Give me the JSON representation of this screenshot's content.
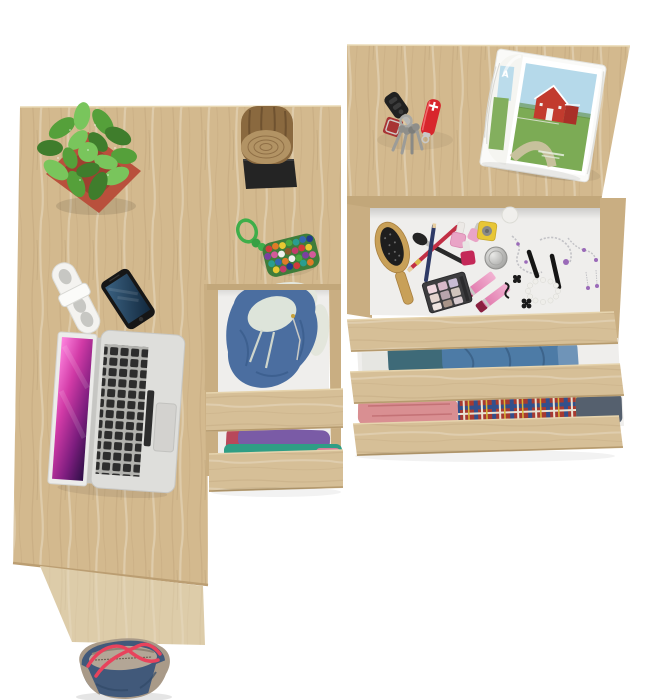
{
  "scene": {
    "description": "Top-down product photo of a light sonoma-oak corner desk unit and matching chest of drawers with open drawers, styled with clothes, cosmetics and accessories on a white background",
    "background_color": "#ffffff"
  },
  "palette": {
    "wood_top": "#d3b98e",
    "wood_front": "#d6bf97",
    "wood_rail": "#c9ae82",
    "wood_edge": "#bb9e72",
    "wood_side_panel": "#ddcca9",
    "drawer_interior": "#efeeec"
  },
  "desk": {
    "label": "corner desk",
    "items": [
      "potted succulent",
      "cable organizer",
      "smartphone",
      "laptop"
    ]
  },
  "cabinet": {
    "label": "desk drawer cabinet",
    "top_items": [
      "log stool on black base",
      "pompom keychain"
    ],
    "drawers": [
      {
        "state": "open",
        "contents": "blue zip hoodie with cream lining"
      },
      {
        "state": "open",
        "contents": "folded purple, teal and red shirts"
      }
    ]
  },
  "dresser": {
    "label": "chest of drawers",
    "top_items": [
      "car key",
      "red pocket knife",
      "keyring with keys",
      "open magazine with red barn photo"
    ],
    "drawers": [
      {
        "state": "open",
        "contents": "cosmetics, makeup and jewelry"
      },
      {
        "state": "open",
        "contents": "folded blue jeans"
      },
      {
        "state": "open",
        "contents": "pink shirts, plaid shirt and dark jeans"
      }
    ]
  },
  "items": {
    "plant": {
      "label": "potted succulent plant",
      "pot_color": "#b9503c",
      "pot_inner": "#9e4030",
      "foliage_dark": "#3f7d2c",
      "foliage_mid": "#55a03a",
      "foliage_light": "#79c55c"
    },
    "cable_organizer": {
      "label": "white cable organizer",
      "body_color": "#f4f3f0",
      "slot_color": "#c7c7c3"
    },
    "smartphone": {
      "label": "smartphone",
      "body_color": "#161616",
      "screen_top": "#3b6282",
      "screen_bottom": "#12283d"
    },
    "laptop": {
      "label": "open laptop",
      "body_color": "#dededb",
      "keyboard_bed": "#b2b2ae",
      "key_color": "#2d2d2d",
      "trackpad_color": "#d3d2cf",
      "screen_colors": [
        "#ff86e0",
        "#d13aa6",
        "#7c1d7e",
        "#2d0f46"
      ]
    },
    "log_stool": {
      "label": "wooden log stool",
      "bark_color": "#8a693f",
      "face_color": "#b29364",
      "ring_color": "#8f6f46",
      "base_color": "#242424"
    },
    "pompom_keychain": {
      "label": "pompom keychain",
      "cord_color": "#3fae4a",
      "pouch_color": "#3f7d3a",
      "pompom_colors": [
        "#d23b3b",
        "#e07b28",
        "#e8c832",
        "#4ba83f",
        "#2a9d8f",
        "#3566b0",
        "#223a8c",
        "#7b3fa0",
        "#d25a9a",
        "#f0f0ec",
        "#8a5a2a",
        "#c23b6a"
      ]
    },
    "hoodie": {
      "label": "blue zip hoodie",
      "color": "#4b6ea0",
      "fold_color": "#3a5c8c",
      "lining_color": "#dde4da",
      "cloth_color": "#e3e6dc"
    },
    "cabinet_shirts": {
      "purple": "#7a5ba6",
      "teal": "#2f9e85",
      "red": "#b8485a",
      "pink": "#d87f9a"
    },
    "car_key": {
      "label": "car key fob",
      "body_color": "#202020",
      "button_color": "#3b3b3b",
      "blade_color": "#b9b9b6"
    },
    "pocket_knife": {
      "label": "red pocket knife",
      "body_color": "#d8262c",
      "emblem_color": "#ffffff",
      "tool_color": "#c9c9c6"
    },
    "keyring": {
      "label": "keyring with keys",
      "fob_color": "#a83434",
      "ring_color": "#a8a8a4",
      "key_color": "#9c9c98",
      "key_head": "#8e8e8a"
    },
    "magazine": {
      "label": "open magazine",
      "page_letter": "A",
      "page_color": "#fafaf8",
      "sky_color": "#b5d9ea",
      "grass_color": "#7cab55",
      "road_color": "#cfc3a4",
      "barn_color": "#c23b2e",
      "barn_side": "#a93028"
    },
    "hairbrush": {
      "label": "wooden hairbrush",
      "wood_color": "#c8a058",
      "bristle_color": "#1e1e1e"
    },
    "makeup": {
      "red_pencil": "#c22f45",
      "navy_pencil": "#2e3a66",
      "brush_handle": "#2a2a2a",
      "polish_pink": "#e9a4c6",
      "polish_red": "#c42858",
      "polish_yellow": "#e8c636",
      "jar_silver": "#b0b0b2",
      "cream_jar": "#f0efec",
      "gloss_pink": "#e077ab",
      "gloss_cap": "#8a2040",
      "palette_case": "#3d3d3f",
      "palette_shades": [
        "#efd7de",
        "#d8b8c8",
        "#c8bcd4",
        "#e4d4ce",
        "#b8a4ac",
        "#cfc4bc",
        "#efe4e0",
        "#a89488",
        "#d8ccd0"
      ]
    },
    "jewelry": {
      "chain_color": "#c2c2c6",
      "pearl_color": "#efeeea",
      "crystal_color": "#9a6ab8",
      "charm_color": "#1a1a1a"
    },
    "jeans": {
      "dark": "#3e6a78",
      "blue": "#4d7ba6",
      "light": "#6f94b8",
      "cloth": "#e6e6e2",
      "fold": "#3a5f84"
    },
    "pink_clothes": {
      "color": "#d98f92",
      "fold": "#c47276"
    },
    "plaid": {
      "base": "#a83a30",
      "stripe_blue": "#33508c",
      "stripe_white": "#e8e2d2",
      "stripe_yellow": "#d8b838",
      "denim": "#55606e"
    },
    "bag": {
      "label": "denim tote bag",
      "body_color": "#41597a",
      "trim_color": "#a99a88",
      "lining_color": "#b3a696",
      "strap_color": "#e8435c",
      "zipper_color": "#6f6455"
    }
  }
}
